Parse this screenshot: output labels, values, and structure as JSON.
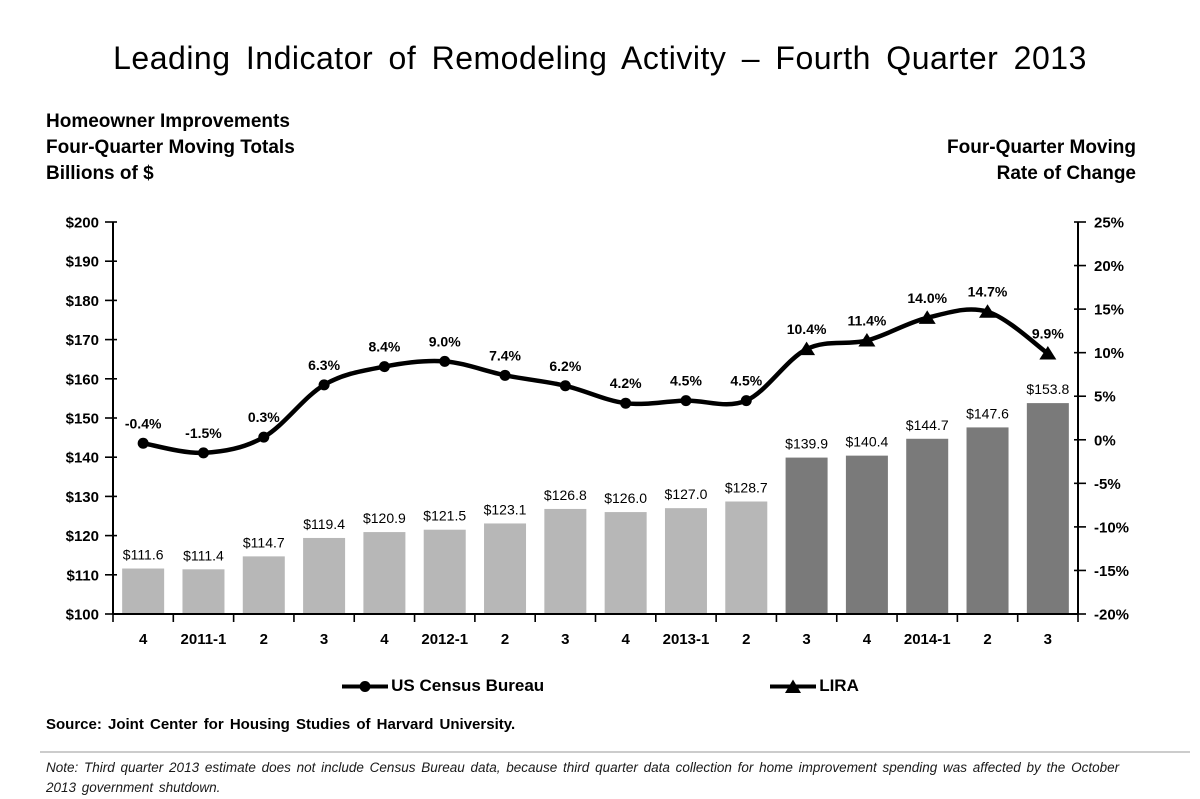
{
  "title": "Leading Indicator of Remodeling Activity – Fourth Quarter 2013",
  "left_header": {
    "line1": "Homeowner Improvements",
    "line2": "Four-Quarter Moving Totals",
    "line3": "Billions of $"
  },
  "right_header": {
    "line1": "Four-Quarter Moving",
    "line2": "Rate of Change"
  },
  "legend": {
    "census_label": "US Census Bureau",
    "lira_label": "LIRA"
  },
  "source": "Source: Joint Center for Housing Studies of Harvard University.",
  "note": "Note: Third quarter 2013 estimate does not include Census Bureau data, because third quarter data collection for home improvement spending was affected by the October 2013 government shutdown.",
  "colors": {
    "bar_light": "#b7b7b7",
    "bar_dark": "#7a7a7a",
    "line": "#000000",
    "divider": "#cccccc"
  },
  "chart_data": {
    "type": "combo-bar-line",
    "categories": [
      "4",
      "2011-1",
      "2",
      "3",
      "4",
      "2012-1",
      "2",
      "3",
      "4",
      "2013-1",
      "2",
      "3",
      "4",
      "2014-1",
      "2",
      "3"
    ],
    "bar_series": {
      "name": "Homeowner Improvements, Four-Quarter Moving Totals (Billions of $)",
      "values": [
        111.6,
        111.4,
        114.7,
        119.4,
        120.9,
        121.5,
        123.1,
        126.8,
        126.0,
        127.0,
        128.7,
        139.9,
        140.4,
        144.7,
        147.6,
        153.8
      ],
      "labels": [
        "$111.6",
        "$111.4",
        "$114.7",
        "$119.4",
        "$120.9",
        "$121.5",
        "$123.1",
        "$126.8",
        "$126.0",
        "$127.0",
        "$128.7",
        "$139.9",
        "$140.4",
        "$144.7",
        "$147.6",
        "$153.8"
      ],
      "split_index": 11,
      "color_light": "#b7b7b7",
      "color_dark": "#7a7a7a"
    },
    "line_series": [
      {
        "name": "US Census Bureau",
        "marker": "circle",
        "start_index": 0,
        "values": [
          -0.4,
          -1.5,
          0.3,
          6.3,
          8.4,
          9.0,
          7.4,
          6.2,
          4.2,
          4.5,
          4.5
        ],
        "labels": [
          "-0.4%",
          "-1.5%",
          "0.3%",
          "6.3%",
          "8.4%",
          "9.0%",
          "7.4%",
          "6.2%",
          "4.2%",
          "4.5%",
          "4.5%"
        ]
      },
      {
        "name": "LIRA",
        "marker": "triangle",
        "start_index": 11,
        "values": [
          10.4,
          11.4,
          14.0,
          14.7,
          9.9
        ],
        "labels": [
          "10.4%",
          "11.4%",
          "14.0%",
          "14.7%",
          "9.9%"
        ]
      }
    ],
    "left_axis": {
      "min": 100,
      "max": 200,
      "tick_labels": [
        "$200",
        "$190",
        "$180",
        "$170",
        "$160",
        "$150",
        "$140",
        "$130",
        "$120",
        "$110",
        "$100"
      ]
    },
    "right_axis": {
      "min": -20,
      "max": 25,
      "tick_labels": [
        "25%",
        "20%",
        "15%",
        "10%",
        "5%",
        "0%",
        "-5%",
        "-10%",
        "-15%",
        "-20%"
      ]
    },
    "legend_position": "bottom",
    "grid": false,
    "connected_line": true
  }
}
